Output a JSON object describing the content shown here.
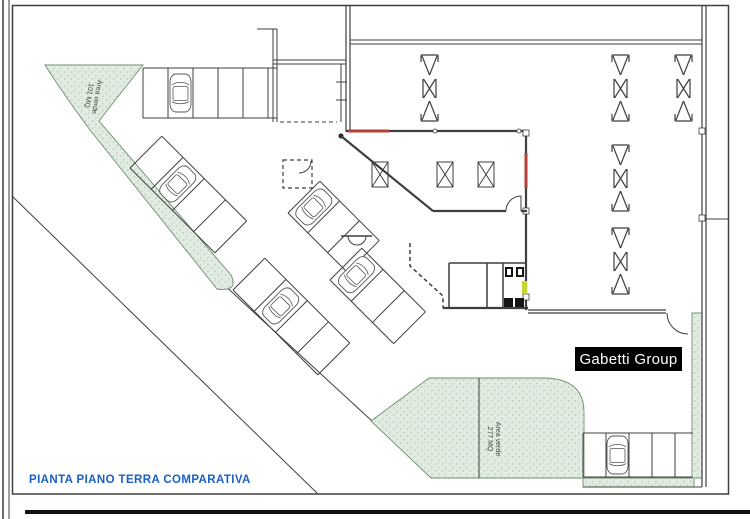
{
  "title": {
    "label": "PIANTA PIANO TERRA COMPARATIVA"
  },
  "branding": {
    "label": "Gabetti Group"
  },
  "green_areas": {
    "north": {
      "line1": "Area verde",
      "line2": "101 MQ"
    },
    "south": {
      "line1": "Area verde",
      "line2": "277 MQ"
    }
  },
  "colors": {
    "wall": "#3f3f3f",
    "door_red": "#b04238",
    "door_lime": "#c6d636",
    "green_fill": "#e2ece2",
    "green_dot": "#aec6ae",
    "green_edge": "#6f8f6f",
    "title_blue": "#1b5fc6",
    "badge_bg": "#000000",
    "badge_fg": "#ffffff",
    "paper": "#ffffff"
  }
}
